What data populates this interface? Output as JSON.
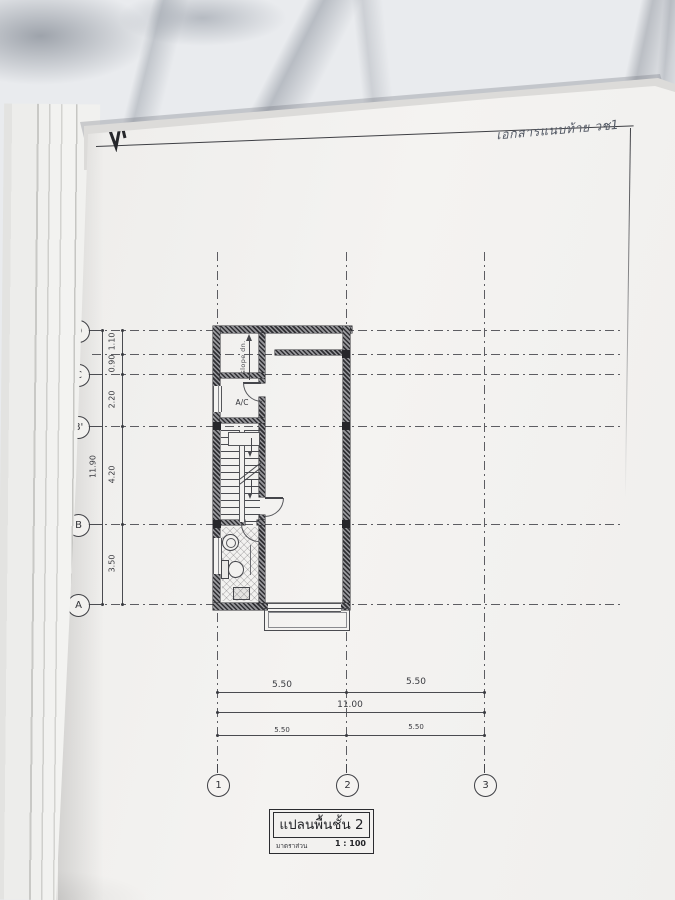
{
  "photo": {
    "surface": "marble-countertop",
    "colors": {
      "paper": "#f2f1ef",
      "ink": "#3c3d42",
      "marble": "#e9ebee",
      "vein": "#9aa0a8"
    }
  },
  "handwritten_note": "เอกสารแนบท้าย วช1",
  "plan": {
    "room_labels": {
      "ac": "A/C"
    },
    "annotations": {
      "slope": "slope dn."
    },
    "grid": {
      "rows": [
        {
          "label": "D"
        },
        {
          "label": "C"
        },
        {
          "label": "B'"
        },
        {
          "label": "B"
        },
        {
          "label": "A"
        }
      ],
      "cols": [
        {
          "label": "1"
        },
        {
          "label": "2"
        },
        {
          "label": "3"
        }
      ]
    },
    "dims_left": {
      "segments": [
        "1.10",
        "0.90",
        "2.20",
        "4.20",
        "3.50"
      ],
      "total": "11.90"
    },
    "dims_bottom": {
      "upper": [
        "5.50",
        "5.50"
      ],
      "total": "11.00",
      "lower": [
        "5.50",
        "5.50"
      ]
    }
  },
  "title_block": {
    "title": "แปลนพื้นชั้น 2",
    "scale_label": "มาตราส่วน",
    "scale_value": "1 : 100"
  }
}
